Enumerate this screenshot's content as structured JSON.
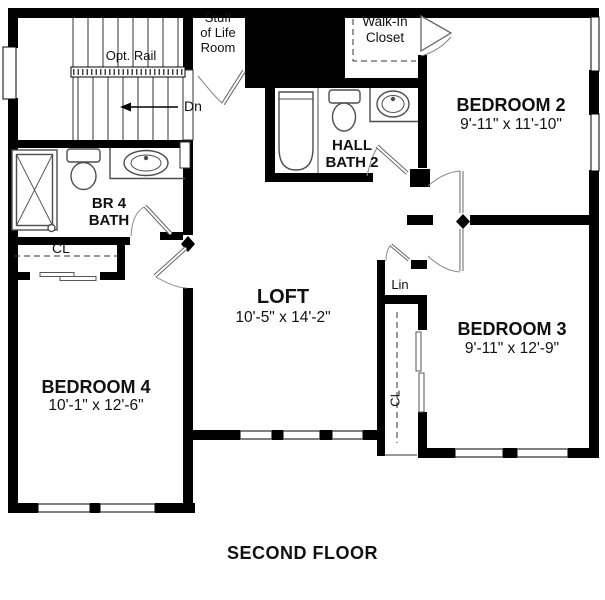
{
  "plan": {
    "title": "SECOND FLOOR",
    "labels": {
      "opt_rail": "Opt. Rail",
      "down": "Dn",
      "stuff_of_life": "Stuff\nof Life\nRoom",
      "walk_in_closet": "Walk-In\nCloset",
      "hall_bath": "HALL\nBATH 2",
      "br4_bath": "BR 4\nBATH",
      "closet_br4": "CL",
      "closet_br3": "CL",
      "linen": "Lin"
    },
    "rooms": {
      "bedroom2": {
        "name": "BEDROOM 2",
        "dims": "9'-11\" x 11'-10\""
      },
      "bedroom3": {
        "name": "BEDROOM 3",
        "dims": "9'-11\" x 12'-9\""
      },
      "bedroom4": {
        "name": "BEDROOM 4",
        "dims": "10'-1\" x 12'-6\""
      },
      "loft": {
        "name": "LOFT",
        "dims": "10'-5\" x 14'-2\""
      }
    },
    "colors": {
      "wall": "#000000",
      "background": "#ffffff",
      "fixture": "#4d4d4d",
      "door_leaf": "#9e9e9e"
    }
  }
}
